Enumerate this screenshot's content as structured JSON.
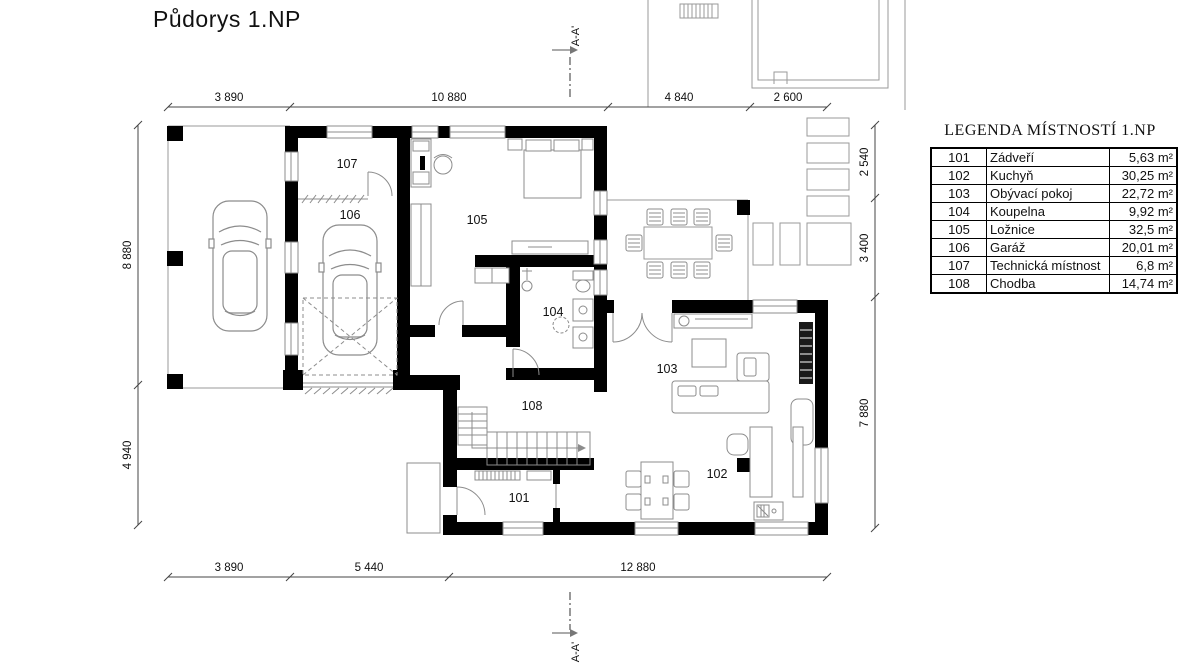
{
  "title": "Půdorys 1.NP",
  "section": {
    "top": "A-A'",
    "bottom": "A-A'"
  },
  "rooms": [
    "101",
    "102",
    "103",
    "104",
    "105",
    "106",
    "107",
    "108"
  ],
  "dimensions": {
    "top": [
      "3 890",
      "10 880",
      "4 840",
      "2 600"
    ],
    "left": [
      "8 880",
      "4 940"
    ],
    "right": [
      "2 540",
      "3 400",
      "7 880"
    ],
    "bottom": [
      "3 890",
      "5 440",
      "12 880"
    ]
  },
  "legend": {
    "title": "LEGENDA MÍSTNOSTÍ 1.NP",
    "rows": [
      {
        "number": "101",
        "name": "Zádveří",
        "area": "5,63 m²"
      },
      {
        "number": "102",
        "name": "Kuchyň",
        "area": "30,25 m²"
      },
      {
        "number": "103",
        "name": "Obývací pokoj",
        "area": "22,72 m²"
      },
      {
        "number": "104",
        "name": "Koupelna",
        "area": "9,92 m²"
      },
      {
        "number": "105",
        "name": "Ložnice",
        "area": "32,5 m²"
      },
      {
        "number": "106",
        "name": "Garáž",
        "area": "20,01 m²"
      },
      {
        "number": "107",
        "name": "Technická místnost",
        "area": "6,8 m²"
      },
      {
        "number": "108",
        "name": "Chodba",
        "area": "14,74 m²"
      }
    ]
  },
  "colors": {
    "wall": "#000000",
    "line": "#8c8c8c",
    "background": "#ffffff"
  }
}
